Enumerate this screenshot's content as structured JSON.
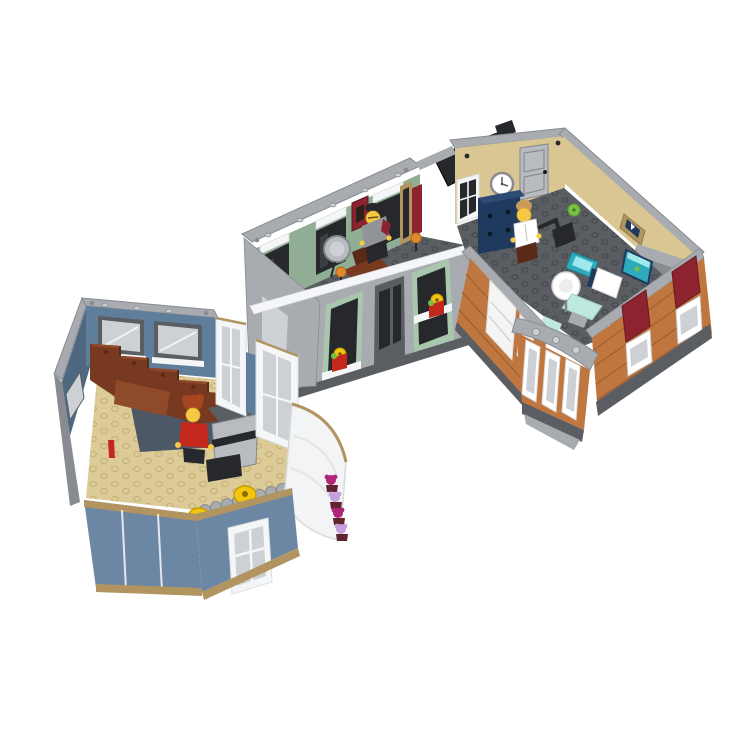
{
  "image": {
    "kind": "product-photo",
    "subject": "Three LEGO modular building room sections displayed on a white background",
    "background": "#ffffff",
    "minifigure_count": 3
  },
  "scene": {
    "modules": [
      {
        "id": "music-room",
        "position": "bottom-left",
        "wall_color_name": "sand-blue",
        "floor_color_name": "tan",
        "elements": [
          "reddish-brown staircase",
          "upright piano",
          "piano bench",
          "musician minifigure with red torso and dark-orange hair",
          "two yellow stools",
          "two gray windows with white sills",
          "white door frames",
          "curved white corner balcony",
          "stacked flower boxes with magenta and lavender flowers",
          "blue front facade with white window",
          "scalloped gray trim",
          "red candle piece"
        ]
      },
      {
        "id": "barbershop",
        "position": "middle",
        "wall_color_name": "sand-green interior, light-gray exterior",
        "floor_color_name": "dark-gray",
        "elements": [
          "barber minifigure with black cap and gray vest",
          "reddish-brown barber chair",
          "round chrome mirror",
          "two trans-orange lamps",
          "dark-red picture frame",
          "tan door frame",
          "dark mirror-station panels with white cornices",
          "three facade window bays with sand-green frames",
          "yellow flowers in red pots on sills",
          "white jumper-tile wall top",
          "black folding camera on wall top"
        ]
      },
      {
        "id": "dentist-office",
        "position": "top-right",
        "wall_color_name": "tan interior, medium-nougat brick exterior",
        "floor_color_name": "dark-gray",
        "elements": [
          "dentist minifigure with white coat and tan hair",
          "white wall clock",
          "silver door",
          "white-framed window",
          "dark-blue cabinet",
          "black dental lamp arm",
          "white and sage dental chair",
          "sink cabinet with teal basin",
          "aquarium with teal water and green fish",
          "small picture frame",
          "two dark-red awnings",
          "white shop windows",
          "rounded corner tower with white windows and gray cap",
          "lime plant"
        ]
      }
    ],
    "counts": {
      "yellow_stools": 2,
      "awnings": 2,
      "flower_blossoms_on_balcony": 4,
      "facade_window_bays_barbershop": 3
    }
  },
  "palette": {
    "bg": "#ffffff",
    "lbg": "#a8acb0",
    "lbg-l": "#cdd1d5",
    "lbg-d": "#888c90",
    "dbg": "#5a5e62",
    "dk": "#26282b",
    "sandgreen": "#8fae94",
    "sandgreen-l": "#a9c7ad",
    "sandblue": "#5f7e9b",
    "sandblue-d": "#4d6880",
    "sandblue-f": "#6c87a3",
    "tanfloor": "#dccb96",
    "tanfloor-d": "#c2ae74",
    "tanwall": "#d9c693",
    "tan-d": "#b1945f",
    "nougat": "#c0763f",
    "nougat-d": "#995c2e",
    "rbrown": "#77391f",
    "rbrown-l": "#8f4a2a",
    "rbrown-d": "#592a16",
    "dkred": "#8e2330",
    "red": "#c4281c",
    "yellow": "#f2c50e",
    "yellow-d": "#c79b00",
    "lime": "#76c043",
    "teal": "#2faabb",
    "teal-l": "#9fe8ec",
    "aqua-l": "#bfe8e0",
    "navy": "#20395e",
    "chrome": "#b8bcc0",
    "chrome-d": "#84888c",
    "torange": "#e08a2e",
    "magenta": "#b02577",
    "lavender": "#c5a0dc",
    "pot": "#5f2430",
    "fig-yellow": "#f6c945",
    "hair-orange": "#a8471f",
    "hair-tan": "#c89b5b",
    "slate": "#4c5866",
    "gray-torso": "#909498",
    "white": "#f5f6f7",
    "white-d": "#dcdee0"
  }
}
